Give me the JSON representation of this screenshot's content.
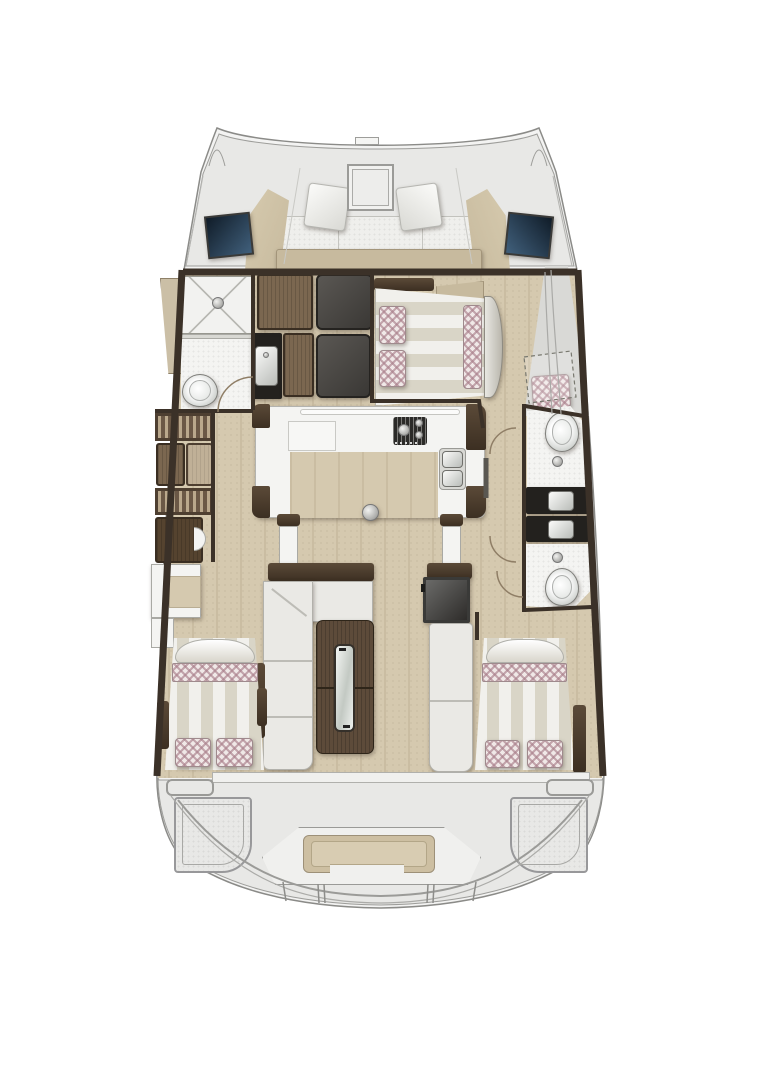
{
  "meta": {
    "diagram_type": "catamaran-interior-floorplan",
    "orientation": "bow-up",
    "visible_text": "none"
  },
  "colors": {
    "hull-fill": "#f3f3f2",
    "outline": "#8b8b88",
    "deck": "#e8e8e6",
    "side-deck": "#d9d9d6",
    "floor": "#d5c9af",
    "floor-grain": "#c3b698",
    "wall": "#3b3128",
    "beige": "#c7ba9e",
    "beige-edge": "#a3957a",
    "cushion": "#efefec",
    "window-a": "#101c28",
    "window-b": "#41607c",
    "wood": "#7b6750",
    "wood-dark": "#55432f",
    "panel-gray": "#4c4946",
    "panel-gray-2": "#3a3835",
    "counter-black": "#23211e",
    "fixture": "#f4f4f2",
    "sofa": "#eae9e5",
    "table-wood": "#5d4b3a",
    "glass": "#e9ede9",
    "checker-base": "#f0e8e7",
    "checker-line": "#a97f8b",
    "stripe-a": "#f1f0ec",
    "stripe-b": "#d9d5c7",
    "tan": "#cdbfa2",
    "steel": "#b9bcb8"
  },
  "areas": {
    "bow": {
      "fixtures": [
        "port-bow-tip",
        "starboard-bow-tip",
        "anchor-fitting",
        "foredeck"
      ]
    },
    "forward_cockpit": {
      "fixtures": [
        "deck-hatch",
        "port-backrest",
        "starboard-backrest",
        "seat-cushions",
        "wedge-cushion-left",
        "wedge-cushion-right",
        "aft-beige-band",
        "port-window",
        "starboard-window"
      ]
    },
    "port_forward_head": {
      "fixtures": [
        "shower-pan",
        "shower-drain",
        "toilet",
        "washbasin-counter",
        "washbasin",
        "door-arc"
      ]
    },
    "port_hull": {
      "fixtures": [
        "wardrobe-panels",
        "hanging-locker-1",
        "hanging-locker-2",
        "cabinet-with-step",
        "desk-counter"
      ]
    },
    "galley": {
      "fixtures": [
        "u-shaped-counter",
        "worktop-lid",
        "stove",
        "double-sink",
        "floor-fitting",
        "companionway-stub-walls"
      ]
    },
    "saloon": {
      "fixtures": [
        "l-shaped-sofa",
        "folding-table",
        "glass-insert",
        "bench-seat",
        "fridge-box"
      ]
    },
    "starboard_forward_cabin": {
      "fixtures": [
        "double-berth",
        "pillows",
        "blanket-band",
        "footboard"
      ]
    },
    "starboard_hull_heads": {
      "fixtures": [
        "toilet-fwd",
        "toilet-aft",
        "washbasin-fwd",
        "washbasin-aft",
        "drains",
        "door-arcs",
        "side-deck-steps",
        "folding-seat-dashed",
        "seat-cushion"
      ]
    },
    "port_aft_cabin": {
      "fixtures": [
        "double-berth",
        "pillows",
        "blanket-band",
        "headboard"
      ]
    },
    "starboard_aft_cabin": {
      "fixtures": [
        "double-berth",
        "pillows",
        "blanket-band",
        "headboard"
      ]
    },
    "aft_cockpit": {
      "fixtures": [
        "transom-band",
        "side-tabs",
        "port-corner-locker",
        "starboard-corner-locker",
        "center-bench",
        "bench-cushion",
        "transom-steps"
      ]
    }
  }
}
